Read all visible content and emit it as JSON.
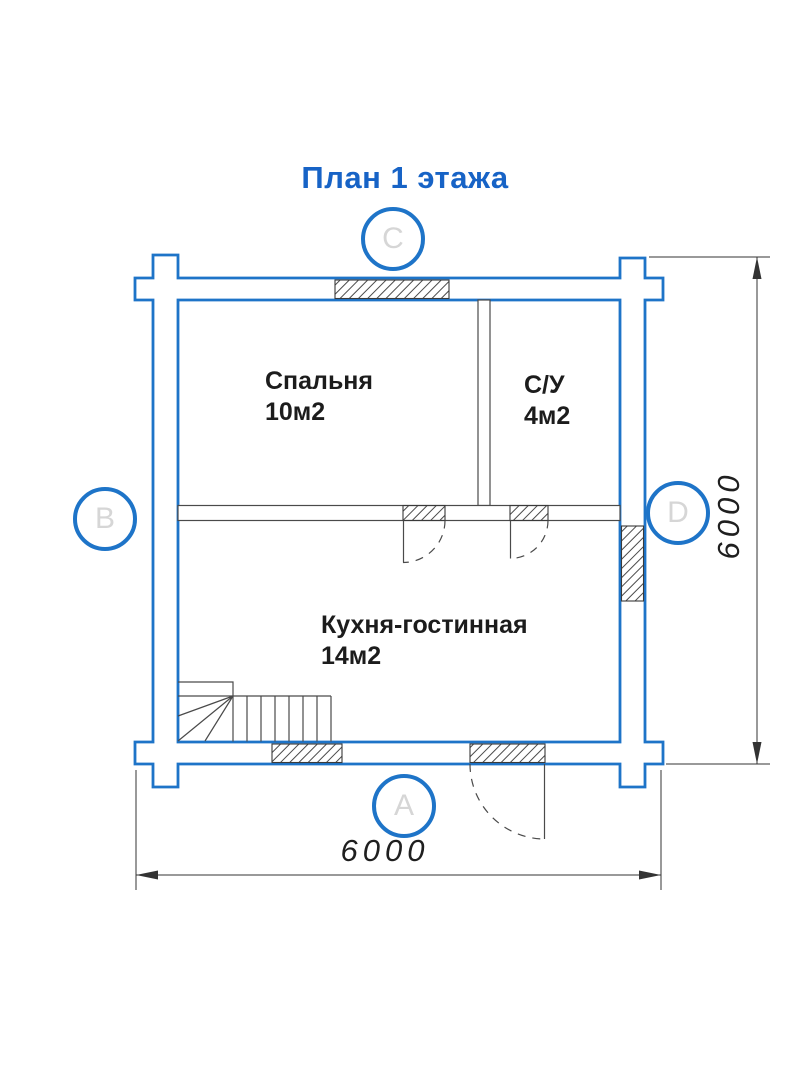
{
  "title": "План 1 этажа",
  "colors": {
    "accent_blue": "#1763c6",
    "wall_blue": "#1e74c8",
    "line_gray": "#4a4a4a",
    "letter_gray": "#d6d6d6",
    "text_dark": "#1c1c1c"
  },
  "axis_markers": {
    "top": "C",
    "left": "B",
    "right": "D",
    "bottom": "A"
  },
  "rooms": [
    {
      "name": "Спальня",
      "area": "10м2"
    },
    {
      "name": "С/У",
      "area": "4м2"
    },
    {
      "name": "Кухня-гостинная",
      "area": "14м2"
    }
  ],
  "dimensions": {
    "bottom": "6000",
    "right": "6000"
  }
}
